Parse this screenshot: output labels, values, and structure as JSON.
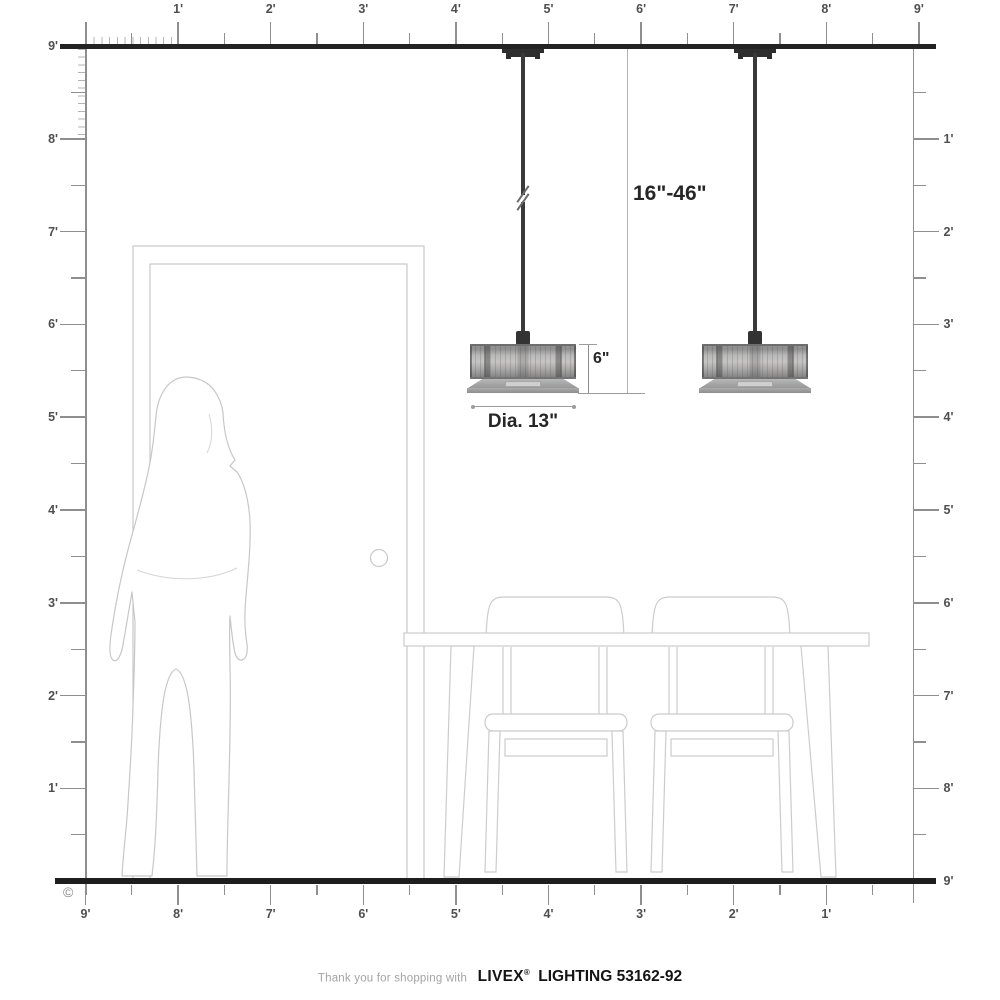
{
  "colors": {
    "structure_dark": "#232323",
    "ruler_gray": "#8f8f8f",
    "outline_light": "#c9c9c9",
    "label_gray": "#4f4f4f",
    "annotation_dark": "#262626"
  },
  "rulers": {
    "top": {
      "labels": [
        "1'",
        "2'",
        "3'",
        "4'",
        "5'",
        "6'",
        "7'",
        "8'",
        "9'"
      ]
    },
    "left": {
      "labels": [
        "9'",
        "8'",
        "7'",
        "6'",
        "5'",
        "4'",
        "3'",
        "2'",
        "1'"
      ]
    },
    "right": {
      "labels": [
        "1'",
        "2'",
        "3'",
        "4'",
        "5'",
        "6'",
        "7'",
        "8'",
        "9'"
      ]
    },
    "bottom": {
      "labels": [
        "9'",
        "8'",
        "7'",
        "6'",
        "5'",
        "4'",
        "3'",
        "2'",
        "1'"
      ]
    }
  },
  "annotations": {
    "drop_range": "16\"-46\"",
    "shade_height": "6\"",
    "diameter": "Dia. 13\"",
    "copyright": "©"
  },
  "footer": {
    "prefix": "Thank you for shopping with",
    "brand": "LIVEX",
    "registered": "®",
    "suffix": "LIGHTING 53162-92"
  }
}
